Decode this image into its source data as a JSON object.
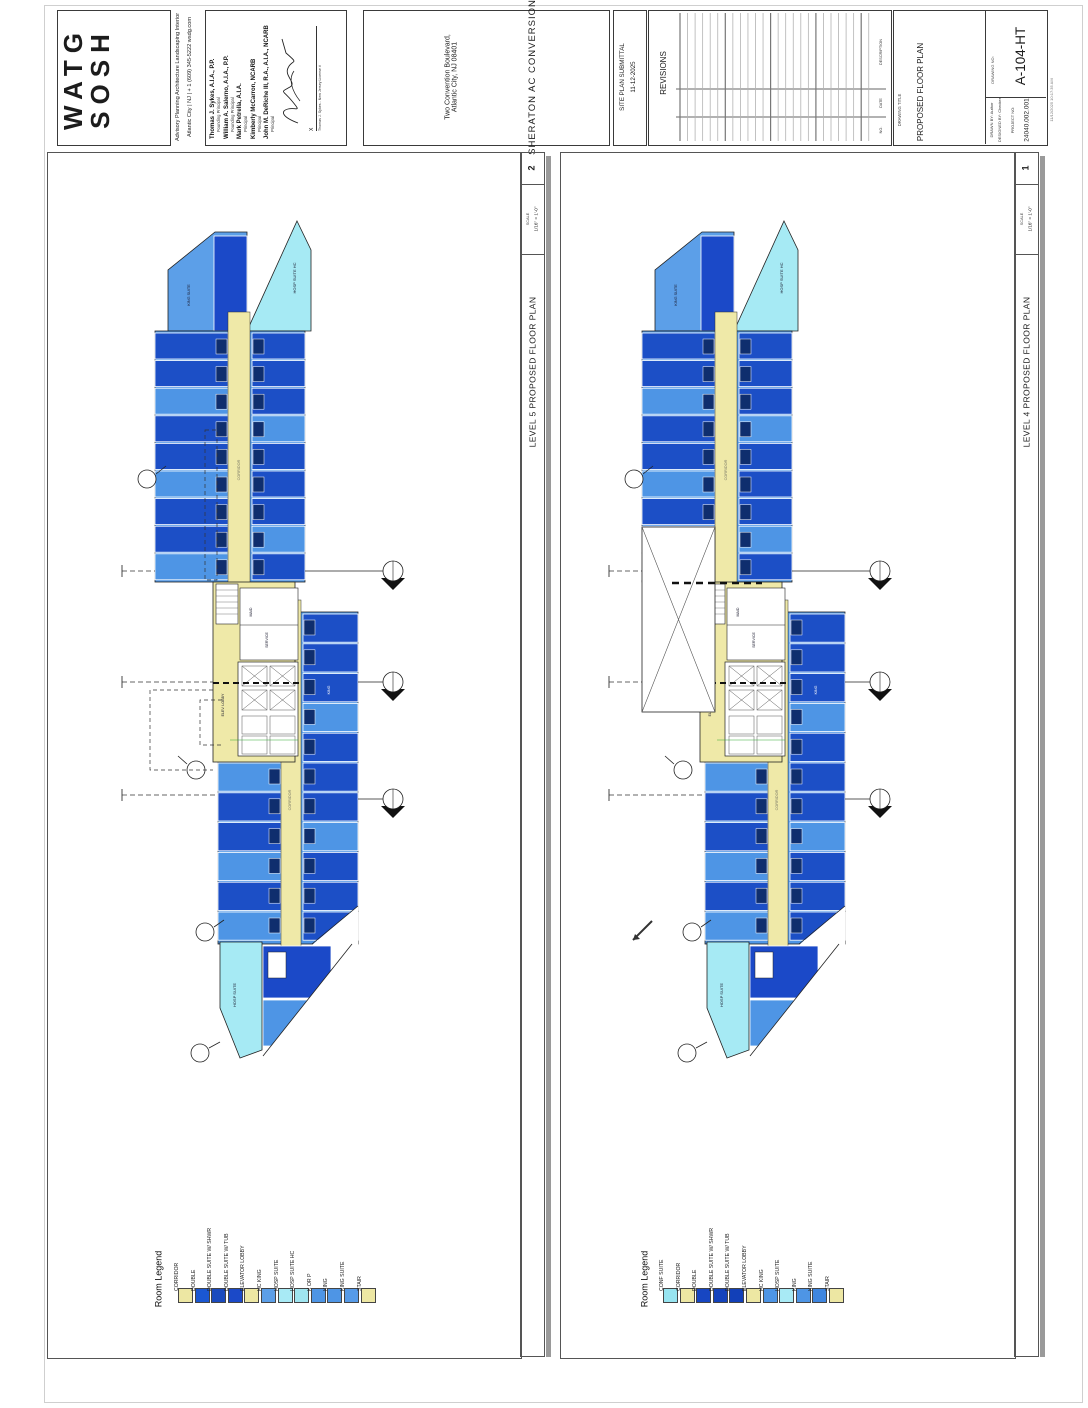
{
  "sheet": {
    "logo1": "WATG",
    "logo2": "SOSH",
    "services": "Advisory    Planning    Architecture    Landscaping    Interior",
    "contact": "Atlantic City  |  NJ  |  + 1 (609) 345-5222          wsdg.com",
    "people": [
      {
        "name": "Thomas J. Sykes, A.I.A., P.P.",
        "title": "Founding Principal"
      },
      {
        "name": "William A. Salerno, A.I.A., P.P.",
        "title": "Founding Principal"
      },
      {
        "name": "Mark Petrella, A.I.A.",
        "title": "Principal"
      },
      {
        "name": "Kimberly McCarron, NCARB",
        "title": "Principal"
      },
      {
        "name": "John M. DeRiche III, R.A., A.I.A., NCARB",
        "title": "Principal"
      }
    ],
    "signature_mark": "X",
    "signature_note": "Thomas J. Sykes - New Jersey License #",
    "address1": "Two Convention Boulevard,",
    "address2": "Atlantic City, NJ 08401",
    "project_name": "SHERATON AC CONVERSION",
    "submittal_title": "SITE PLAN SUBMITTAL",
    "submittal_date": "11-12-2025",
    "revisions_title": "REVISIONS",
    "rev_col_description": "DESCRIPTION",
    "rev_col_date": "DATE",
    "rev_col_no": "NO.",
    "drawing_title_label": "DRAWING TITLE",
    "drawing_title": "PROPOSED FLOOR PLAN",
    "drawing_no_label": "DRAWING NO:",
    "drawing_no": "A-104-HT",
    "drawn_by": "DRAWN BY:   Author",
    "designed_by": "DESIGNED BY:   Checker",
    "project_no_label": "PROJECT NO:",
    "project_no": "24040.002.001",
    "print_stamp": "11/12/2025  10:17:35 AM"
  },
  "viewports": [
    {
      "id": "level5",
      "number": "2",
      "title": "LEVEL 5 PROPOSED FLOOR PLAN",
      "scale_label": "SCALE",
      "scale": "1/16\" = 1'-0\"",
      "legend_title": "Room Legend",
      "legend": [
        {
          "label": "CORRIDOR",
          "color": "#EDE7A3"
        },
        {
          "label": "DOUBLE",
          "color": "#1A57D2"
        },
        {
          "label": "DOUBLE SUITE W/ SHWR",
          "color": "#1A4ABE"
        },
        {
          "label": "DOUBLE SUITE W/ TUB",
          "color": "#1B49C8"
        },
        {
          "label": "ELEVATOR LOBBY",
          "color": "#EDE7A3"
        },
        {
          "label": "HC KING",
          "color": "#5C9FE8"
        },
        {
          "label": "HOSP SUITE",
          "color": "#A8EAF5"
        },
        {
          "label": "HOSP SUITE HC",
          "color": "#9FE5F0"
        },
        {
          "label": "K OR P",
          "color": "#4E95E5"
        },
        {
          "label": "KING",
          "color": "#4E95E5"
        },
        {
          "label": "KING SUITE",
          "color": "#579BE8"
        },
        {
          "label": "STAIR",
          "color": "#EDE7A3"
        }
      ]
    },
    {
      "id": "level4",
      "number": "1",
      "title": "LEVEL 4 PROPOSED FLOOR PLAN",
      "scale_label": "SCALE",
      "scale": "1/16\" = 1'-0\"",
      "legend_title": "Room Legend",
      "legend": [
        {
          "label": "CONF SUITE",
          "color": "#97E4F0"
        },
        {
          "label": "CORRIDOR",
          "color": "#EDE7A3"
        },
        {
          "label": "DOUBLE",
          "color": "#1746C2"
        },
        {
          "label": "DOUBLE SUITE W/ SHWR",
          "color": "#1443BC"
        },
        {
          "label": "DOUBLE SUITE W/ TUB",
          "color": "#1240B8"
        },
        {
          "label": "ELEVATOR LOBBY",
          "color": "#EDE7A3"
        },
        {
          "label": "HC KING",
          "color": "#4E95E5"
        },
        {
          "label": "HOSP SUITE",
          "color": "#A8EAF5"
        },
        {
          "label": "KING",
          "color": "#4E95E5"
        },
        {
          "label": "KING SUITE",
          "color": "#3F86E0"
        },
        {
          "label": "STAIR",
          "color": "#EDE7A3"
        }
      ]
    }
  ],
  "plan_labels": {
    "hosp_suite_hc": "HOSP SUITE HC",
    "king_suite": "KING SUITE",
    "corridor": "CORRIDOR",
    "maid": "MAID",
    "service": "SERVICE",
    "elev_lobby": "ELEV. LOBBY",
    "hosp_suite": "HOSP SUITE",
    "king": "KING"
  }
}
